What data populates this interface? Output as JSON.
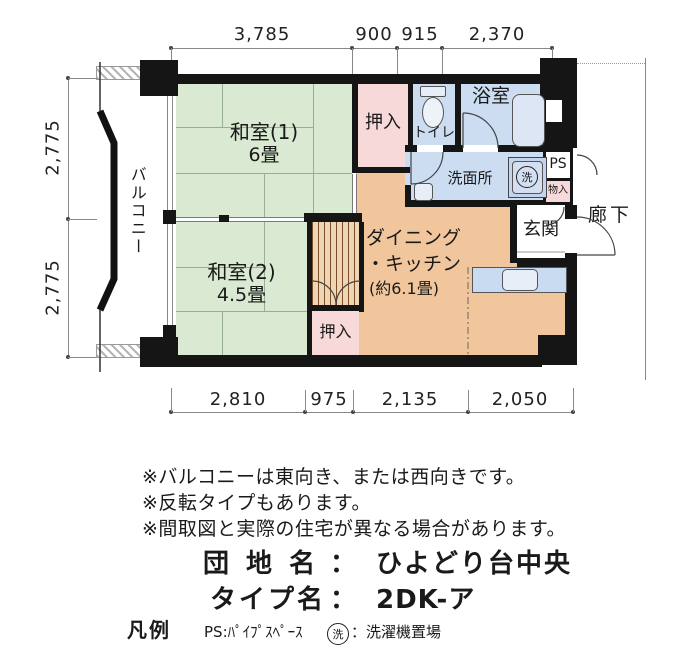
{
  "dim_top": [
    "3,785",
    "900",
    "915",
    "2,370"
  ],
  "dim_bottom": [
    "2,810",
    "975",
    "2,135",
    "2,050"
  ],
  "dim_left": [
    "2,775",
    "2,775"
  ],
  "rooms": {
    "washitsu1_name": "和室(1)",
    "washitsu1_size": "6畳",
    "washitsu2_name": "和室(2)",
    "washitsu2_size": "4.5畳",
    "dk_line1": "ダイニング",
    "dk_line2": "・キッチン",
    "dk_line3": "(約6.1畳)",
    "oshiire_top": "押入",
    "oshiire_bottom": "押入",
    "toilet": "トイレ",
    "bath": "浴室",
    "washroom": "洗面所",
    "ps": "PS",
    "storage_small": "物入",
    "genkan": "玄関",
    "corridor": "廊下",
    "balcony": "バルコニー",
    "washer_mark": "洗"
  },
  "notes": [
    "※バルコニーは東向き、または西向きです。",
    "※反転タイプもあります。",
    "※間取図と実際の住宅が異なる場合があります。"
  ],
  "info": {
    "danchi_label": "団 地 名",
    "separator": "：",
    "danchi_value": "ひよどり台中央",
    "type_label": "タイプ名",
    "type_value": "2DK-ア"
  },
  "legend": {
    "title": "凡例",
    "ps_desc": "PS:ﾊﾟｲﾌﾟｽﾍﾟｰｽ",
    "washer_mark": "洗",
    "washer_desc": "：洗濯機置場"
  },
  "colors": {
    "wall": "#151515",
    "tatami_green": "#d9e9d2",
    "closet_pink": "#f7d9d9",
    "wet_blue": "#ccddf1",
    "dk_orange": "#f2c69c",
    "stripe_brown": "#7d4e2a"
  }
}
